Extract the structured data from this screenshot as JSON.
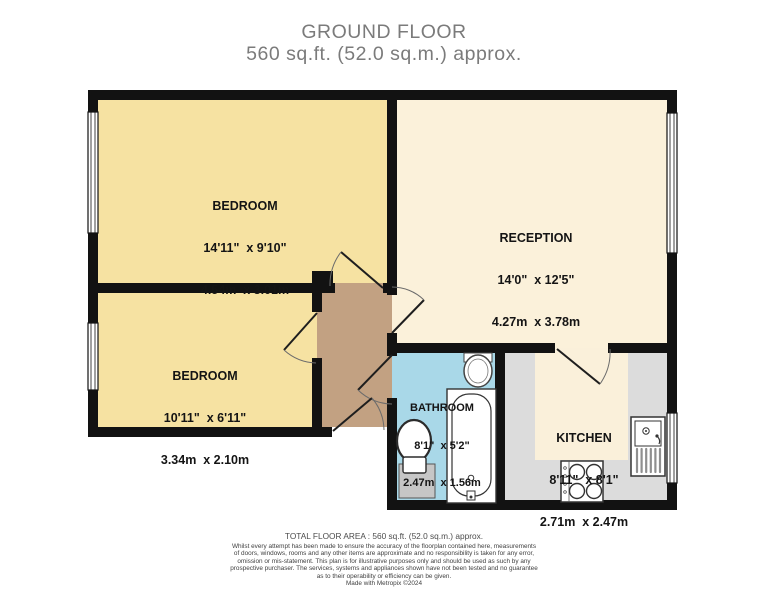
{
  "title": {
    "line1": "GROUND FLOOR",
    "line2": "560 sq.ft. (52.0 sq.m.) approx."
  },
  "rooms": {
    "bedroom1": {
      "name": "BEDROOM",
      "imperial": "14'11\"  x 9'10\"",
      "metric": "4.54m  x 3.01m"
    },
    "bedroom2": {
      "name": "BEDROOM",
      "imperial": "10'11\"  x 6'11\"",
      "metric": "3.34m  x 2.10m"
    },
    "reception": {
      "name": "RECEPTION",
      "imperial": "14'0\"  x 12'5\"",
      "metric": "4.27m  x 3.78m"
    },
    "bathroom": {
      "name": "BATHROOM",
      "imperial": "8'1\"  x 5'2\"",
      "metric": "2.47m  x 1.56m"
    },
    "kitchen": {
      "name": "KITCHEN",
      "imperial": "8'11\"  x 8'1\"",
      "metric": "2.71m  x 2.47m"
    }
  },
  "footer": {
    "total_area": "TOTAL FLOOR AREA : 560 sq.ft. (52.0 sq.m.) approx.",
    "disclaimer_lines": [
      "Whilst every attempt has been made to ensure the accuracy of the floorplan contained here, measurements",
      "of doors, windows, rooms and any other items are approximate and no responsibility is taken for any error,",
      "omission or mis-statement. This plan is for illustrative purposes only and should be used as such by any",
      "prospective purchaser. The services, systems and appliances shown have not been tested and no guarantee",
      "as to their operability or efficiency can be given."
    ],
    "credit": "Made with Metropix ©2024"
  },
  "colors": {
    "wall": "#121212",
    "bedroom_fill": "#f6e2a2",
    "reception_fill": "#fbf1da",
    "hallway_fill": "#c2a182",
    "bathroom_fill": "#a9d8e8",
    "kitchen_counter_fill": "#dcdcdc",
    "kitchen_floor_fill": "#faf0da",
    "title_text": "#7b7b7b"
  }
}
